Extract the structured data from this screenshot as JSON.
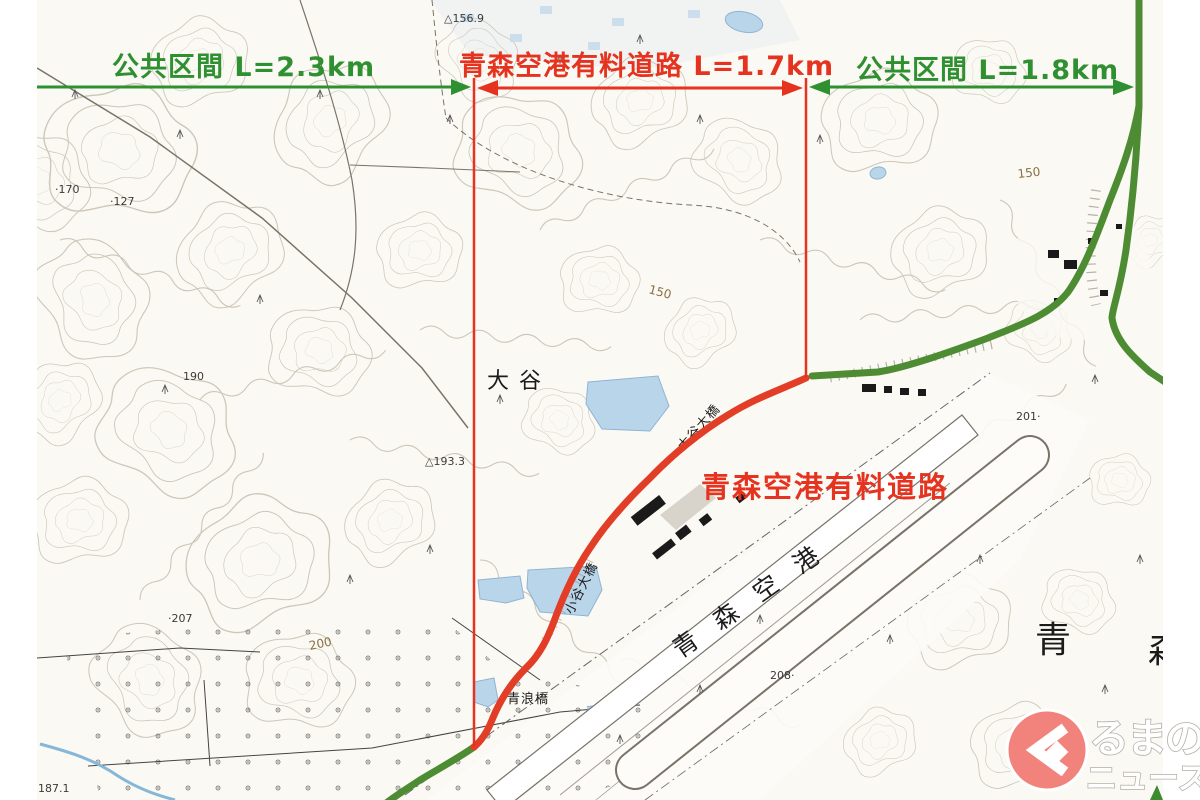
{
  "annotations": {
    "segments": [
      {
        "id": "left-public",
        "label": "公共区間 L=2.3km",
        "color": "#2e9030"
      },
      {
        "id": "toll-road",
        "label": "青森空港有料道路 L=1.7km",
        "color": "#e5331f"
      },
      {
        "id": "right-public",
        "label": "公共区間 L=1.8km",
        "color": "#2e9030"
      }
    ],
    "road_label": "青森空港有料道路"
  },
  "map": {
    "place_labels": {
      "otani": "大谷",
      "otani_bridge": "大谷大橋",
      "kotani_bridge": "小谷大橋",
      "aonami_bridge": "青浪橋",
      "airport": "青森空港",
      "aomori_big_1": "青",
      "aomori_big_2": "森"
    },
    "elevation_labels": {
      "e156": "△156.9",
      "e170": "·170",
      "e127": "·127",
      "e190": "190",
      "e193": "△193.3",
      "e207": "·207",
      "e201": "201·",
      "e208": "208·",
      "e187": "187.1",
      "c200": "200",
      "c150a": "150",
      "c150b": "150"
    }
  },
  "logo": {
    "line1": "るまの",
    "line2": "ニュース"
  },
  "colors": {
    "annotation_green": "#2e9030",
    "annotation_red": "#e5331f",
    "road_green": "#4d8c33",
    "road_red": "#e23d26",
    "water_blue": "#b9d5ea",
    "contour": "#9e957f",
    "logo_pink": "#f2837c"
  }
}
